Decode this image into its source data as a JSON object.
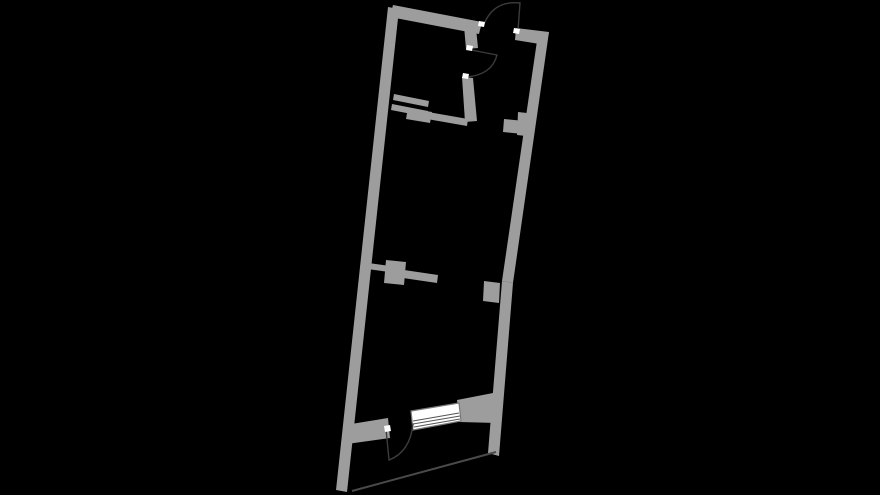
{
  "figure": {
    "kind": "floor-plan",
    "features": [
      {
        "name": "exterior-walls",
        "type": "wall"
      },
      {
        "name": "entrance-door",
        "type": "door-swing"
      },
      {
        "name": "bathroom",
        "type": "room"
      },
      {
        "name": "bathroom-door",
        "type": "door-swing"
      },
      {
        "name": "hallway-wall-stub",
        "type": "wall"
      },
      {
        "name": "mid-partition",
        "type": "wall"
      },
      {
        "name": "right-wall-stub",
        "type": "wall"
      },
      {
        "name": "balcony-door",
        "type": "door-swing"
      },
      {
        "name": "window",
        "type": "window"
      },
      {
        "name": "terrace-edge",
        "type": "boundary-line"
      }
    ]
  },
  "colors": {
    "background": "#000000",
    "wall": "#9d9d9d",
    "door_arc": "#3c3c3c",
    "jamb": "#ffffff",
    "window_fill": "#ffffff",
    "window_frame": "#787878",
    "glazing": "#555555",
    "terrace_edge": "#4a4a4a"
  }
}
